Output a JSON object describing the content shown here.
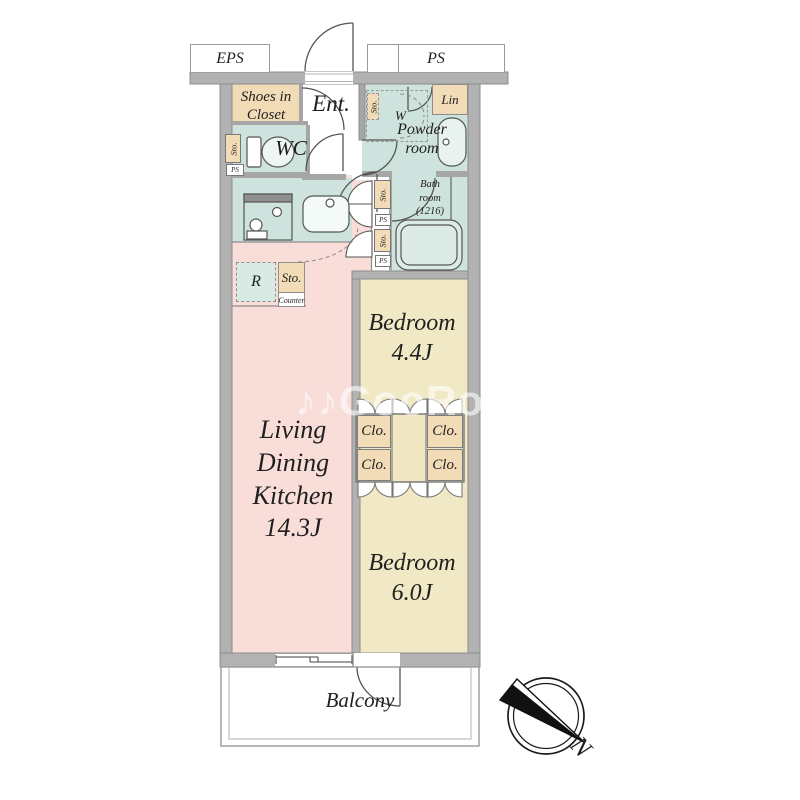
{
  "colors": {
    "wall": "#b2b2b2",
    "room_teal": "#cfe3de",
    "room_pink": "#f8ddd9",
    "room_cream": "#f1e9c5",
    "closet_beige": "#f2dcb8",
    "outline": "#555555"
  },
  "shafts": {
    "eps": "EPS",
    "ps": "PS"
  },
  "entrance": {
    "label": "Ent."
  },
  "shoes_closet": {
    "line1": "Shoes in",
    "line2": "Closet"
  },
  "wc": {
    "label": "WC",
    "sto_tag": "Sto.",
    "ps_tag": "PS"
  },
  "washer_space": {
    "w": "W",
    "sto_tag": "Sto."
  },
  "linen": {
    "label": "Lin"
  },
  "powder_room": {
    "line1": "Powder",
    "line2": "room"
  },
  "bath_room": {
    "line1": "Bath",
    "line2": "room",
    "line3": "(1216)"
  },
  "kitchen": {
    "fridge": "R",
    "sto": "Sto.",
    "counter": "Counter"
  },
  "hall_tags": {
    "sto_upper": "Sto.",
    "ps_upper": "PS",
    "sto_lower": "Sto.",
    "ps_lower": "PS"
  },
  "ldk": {
    "line1": "Living",
    "line2": "Dining",
    "line3": "Kitchen",
    "area": "14.3J"
  },
  "bedroom_small": {
    "name": "Bedroom",
    "area": "4.4J"
  },
  "bedroom_large": {
    "name": "Bedroom",
    "area": "6.0J"
  },
  "closets": {
    "labels": [
      "Clo.",
      "Clo.",
      "Clo.",
      "Clo."
    ]
  },
  "balcony": {
    "label": "Balcony"
  },
  "compass": {
    "north": "N"
  },
  "watermark": {
    "text": "♪♪GooRooM"
  }
}
